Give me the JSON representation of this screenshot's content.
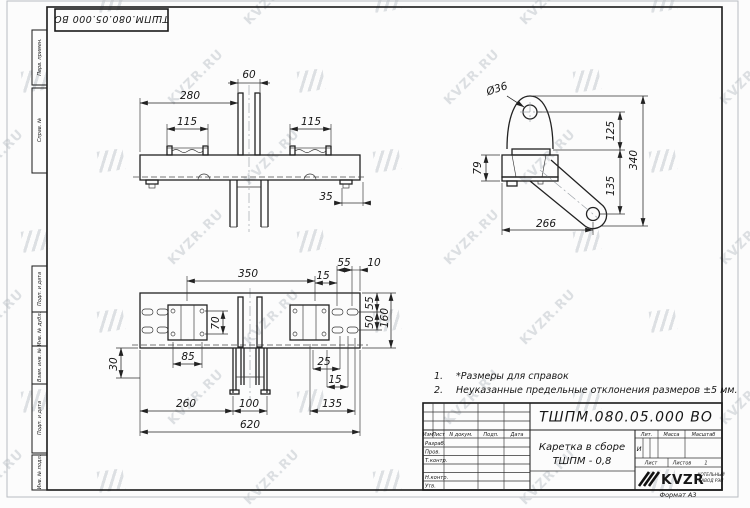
{
  "sheet": {
    "watermark": "KVZR.RU",
    "format_label": "Формат А3"
  },
  "frame_labels": {
    "perv_primen": "Перв. примен.",
    "sprav_no": "Справ. №",
    "podp_data_1": "Подп. и дата",
    "inv_dubl": "Инв. № дубл.",
    "vzam_inv": "Взам. инв. №",
    "podp_data_2": "Подп. и дата",
    "inv_podl": "Инв. № подл."
  },
  "notes": {
    "n1_num": "1.",
    "n1_text": "*Размеры для справок",
    "n2_num": "2.",
    "n2_text": "Неуказанные предельные отклонения размеров  ±5 мм."
  },
  "title_block": {
    "designation": "ТШПМ.080.05.000  ВО",
    "name_line1": "Каретка в сборе",
    "name_line2": "ТШПМ - 0,8",
    "col_izm": "Изм",
    "col_list": "Лист",
    "col_ndok": "N докум.",
    "col_podp": "Подп.",
    "col_data": "Дата",
    "row_razrab": "Разраб.",
    "row_prov": "Пров.",
    "row_tkontr": "Т.контр.",
    "row_nkontr": "Н.контр.",
    "row_utv": "Утв.",
    "lit_label": "Лит.",
    "massa_label": "Масса",
    "masshtab_label": "Масштаб",
    "lit_value": "И",
    "list_label": "Лист",
    "listov_label": "Листов",
    "listov_value": "1",
    "logo_text": "KVZR",
    "logo_sub1": "КОТЕЛЬНЫЙ",
    "logo_sub2": "ЗАВОД РЭП"
  },
  "views": {
    "front": {
      "d60": "60",
      "d280": "280",
      "d115_left": "115",
      "d115_right": "115",
      "d35": "35"
    },
    "side": {
      "dia36": "Ø36",
      "d125": "125",
      "d340": "340",
      "d79": "79",
      "d135": "135",
      "d266": "266"
    },
    "plan": {
      "d350": "350",
      "d15_top": "15",
      "d55_top": "55",
      "d10_top": "10",
      "d55_right": "55",
      "d50_right": "50",
      "d160": "160",
      "d70": "70",
      "d85": "85",
      "d30": "30",
      "d25": "25",
      "d15_bottom": "15",
      "d260": "260",
      "d100": "100",
      "d135_bottom": "135",
      "d620": "620"
    }
  }
}
